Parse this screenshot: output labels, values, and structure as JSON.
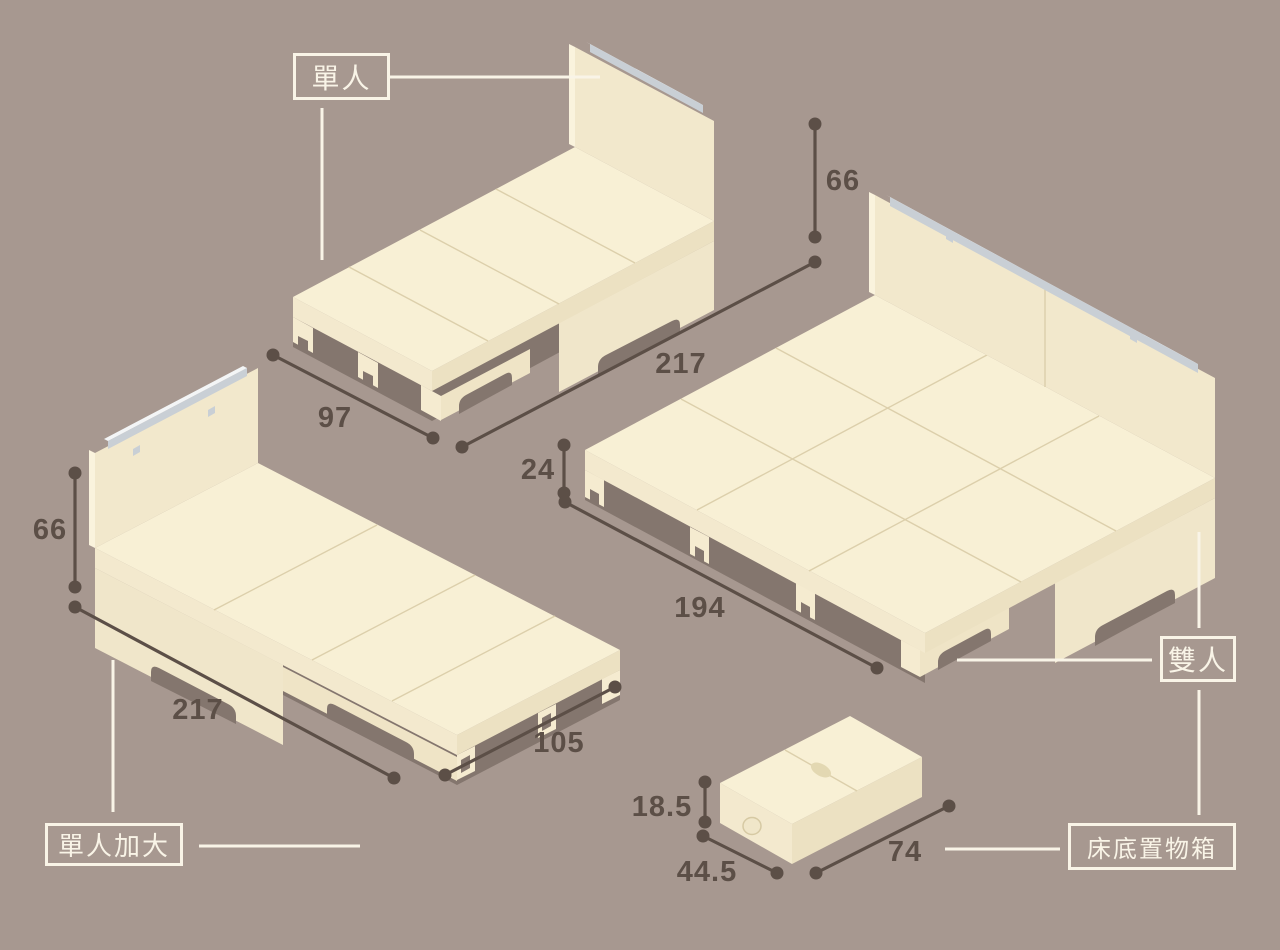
{
  "page": {
    "bg_color": "#a79890",
    "ink_color": "#5c4f47",
    "light_color": "#f9f4e7",
    "wood_color": "#f8f0d5"
  },
  "products": {
    "single": {
      "label": "單人",
      "headboard_height": "66",
      "length": "217",
      "width": "97"
    },
    "double": {
      "label": "雙人",
      "platform_height": "24",
      "width": "194"
    },
    "single_xl": {
      "label": "單人加大",
      "headboard_height": "66",
      "length": "217",
      "width": "105"
    },
    "storage_box": {
      "label": "床底置物箱",
      "height": "18.5",
      "depth": "44.5",
      "width": "74"
    }
  }
}
